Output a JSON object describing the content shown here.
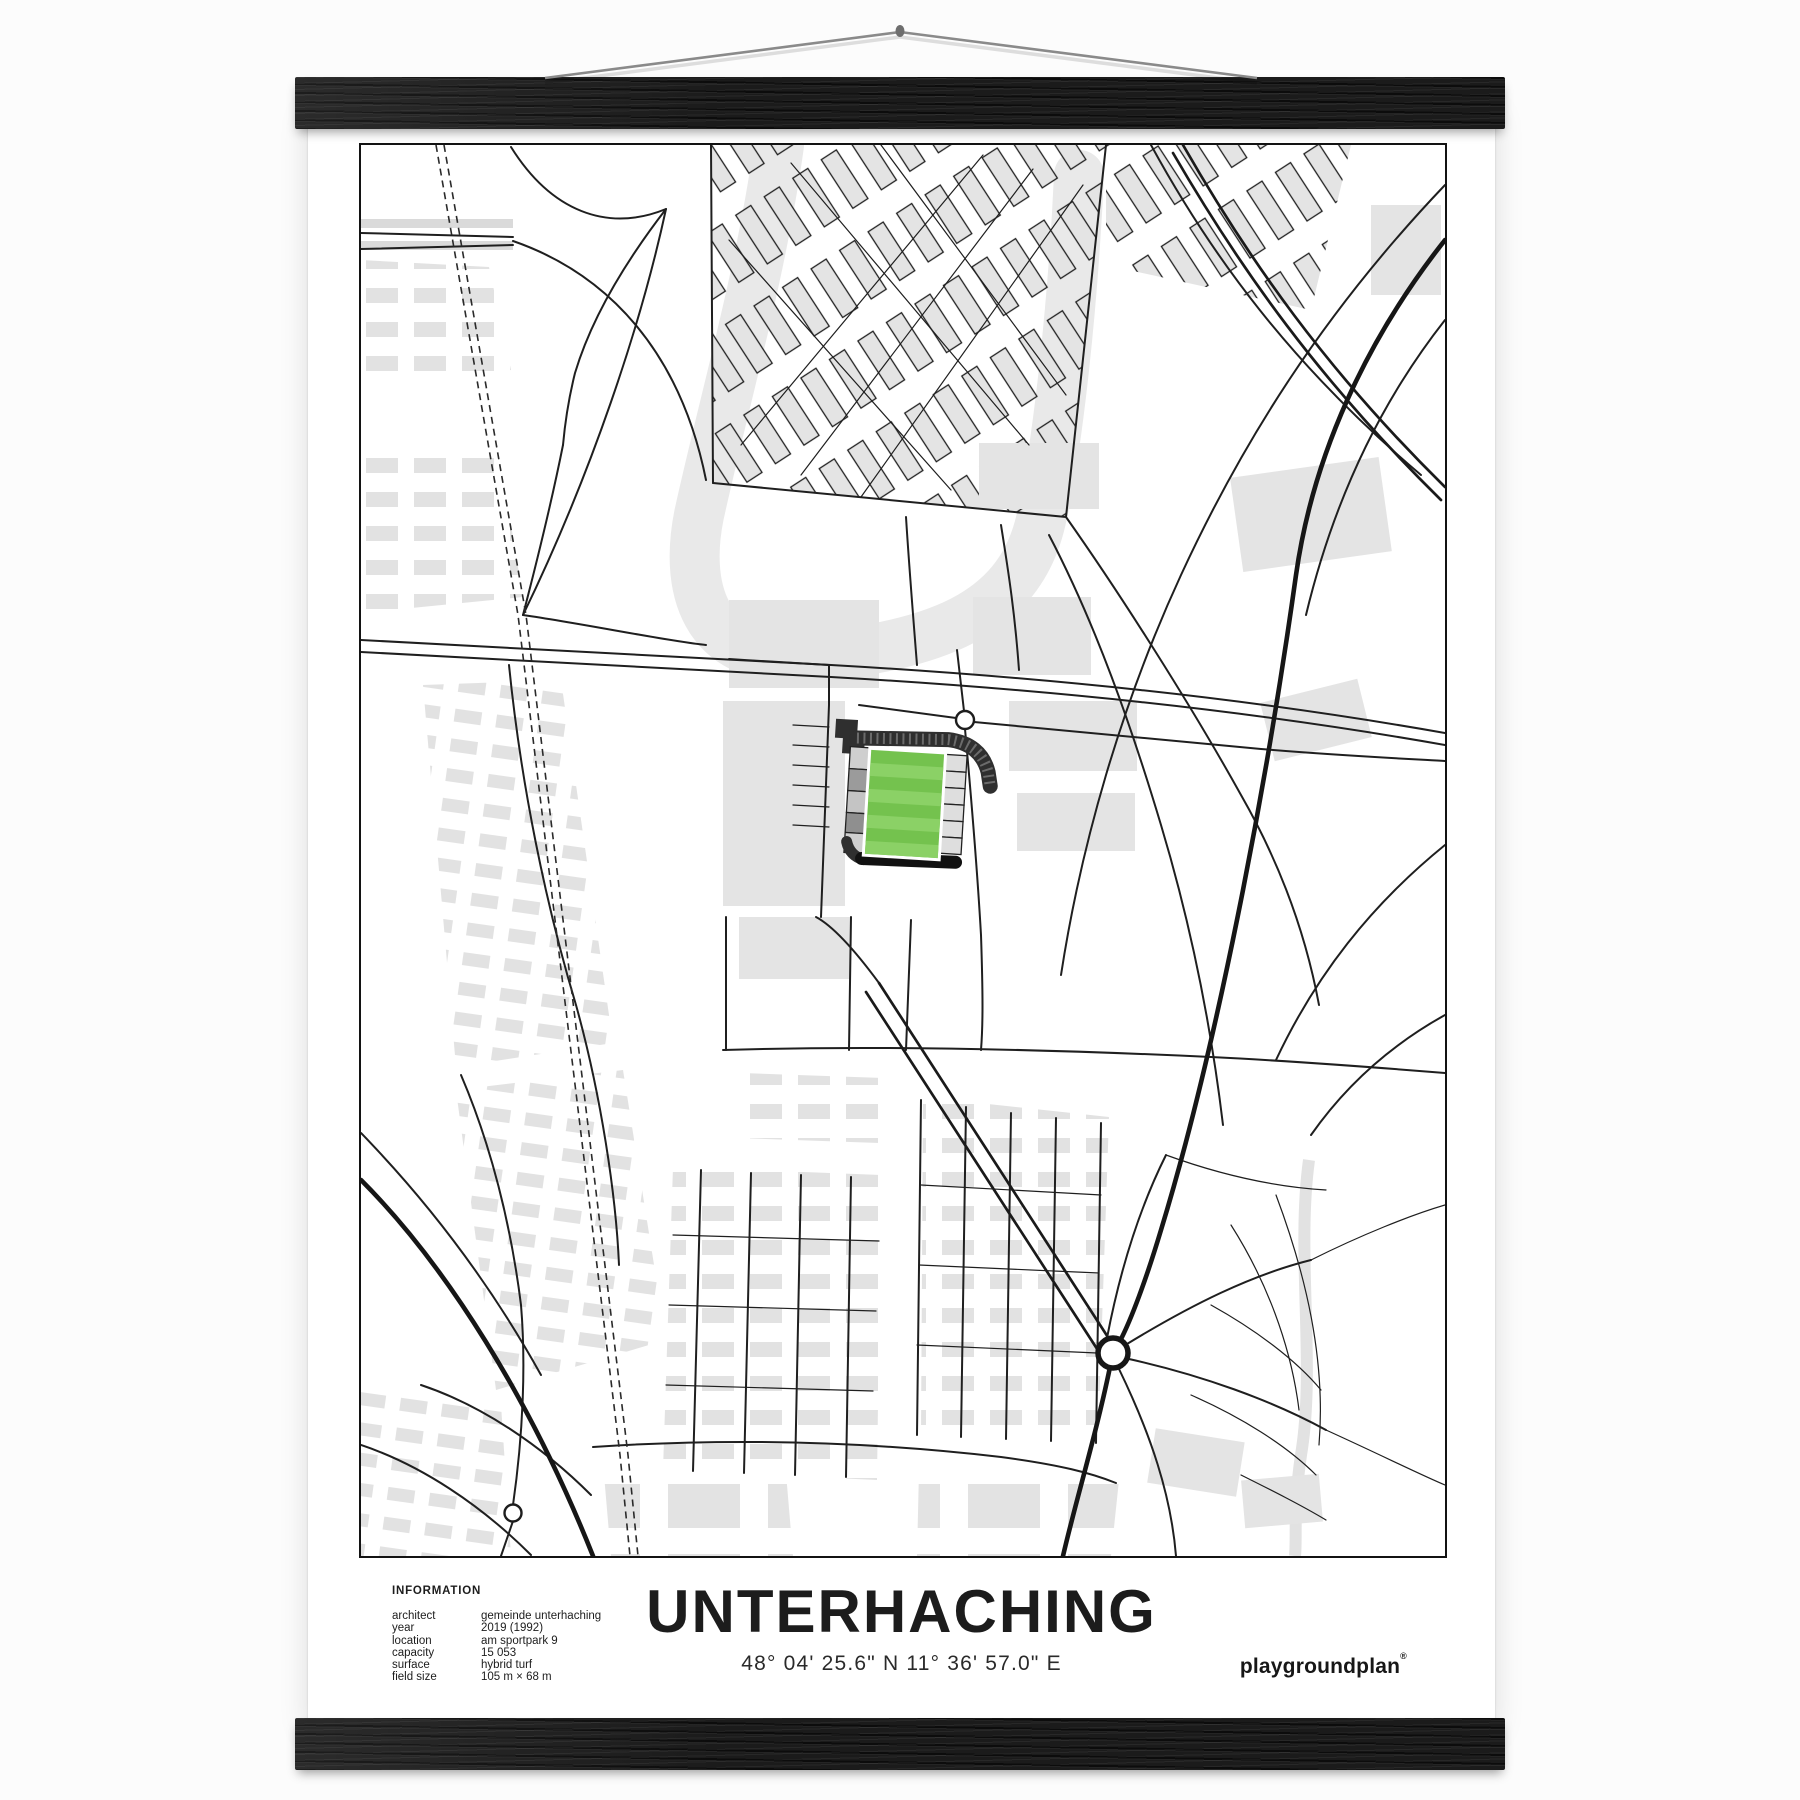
{
  "poster": {
    "title": "UNTERHACHING",
    "coordinates": "48° 04' 25.6\" N 11° 36' 57.0\" E",
    "brand": {
      "name": "playgroundplan",
      "mark": "®"
    },
    "information": {
      "heading": "INFORMATION",
      "rows": [
        {
          "label": "architect",
          "value": "gemeinde unterhaching"
        },
        {
          "label": "year",
          "value": "2019 (1992)"
        },
        {
          "label": "location",
          "value": "am sportpark 9"
        },
        {
          "label": "capacity",
          "value": "15 053"
        },
        {
          "label": "surface",
          "value": "hybrid turf"
        },
        {
          "label": "field size",
          "value": "105 m × 68 m"
        }
      ]
    }
  },
  "map": {
    "type": "stadium-street-map",
    "colors": {
      "pitch_green": "#74c24e",
      "pitch_stripe_green": "#8bd166",
      "road_black": "#1f1f1f",
      "building_gray": "#e4e4e4",
      "rail_wood_black": "#1b1b1b",
      "paper_white": "#ffffff"
    }
  }
}
